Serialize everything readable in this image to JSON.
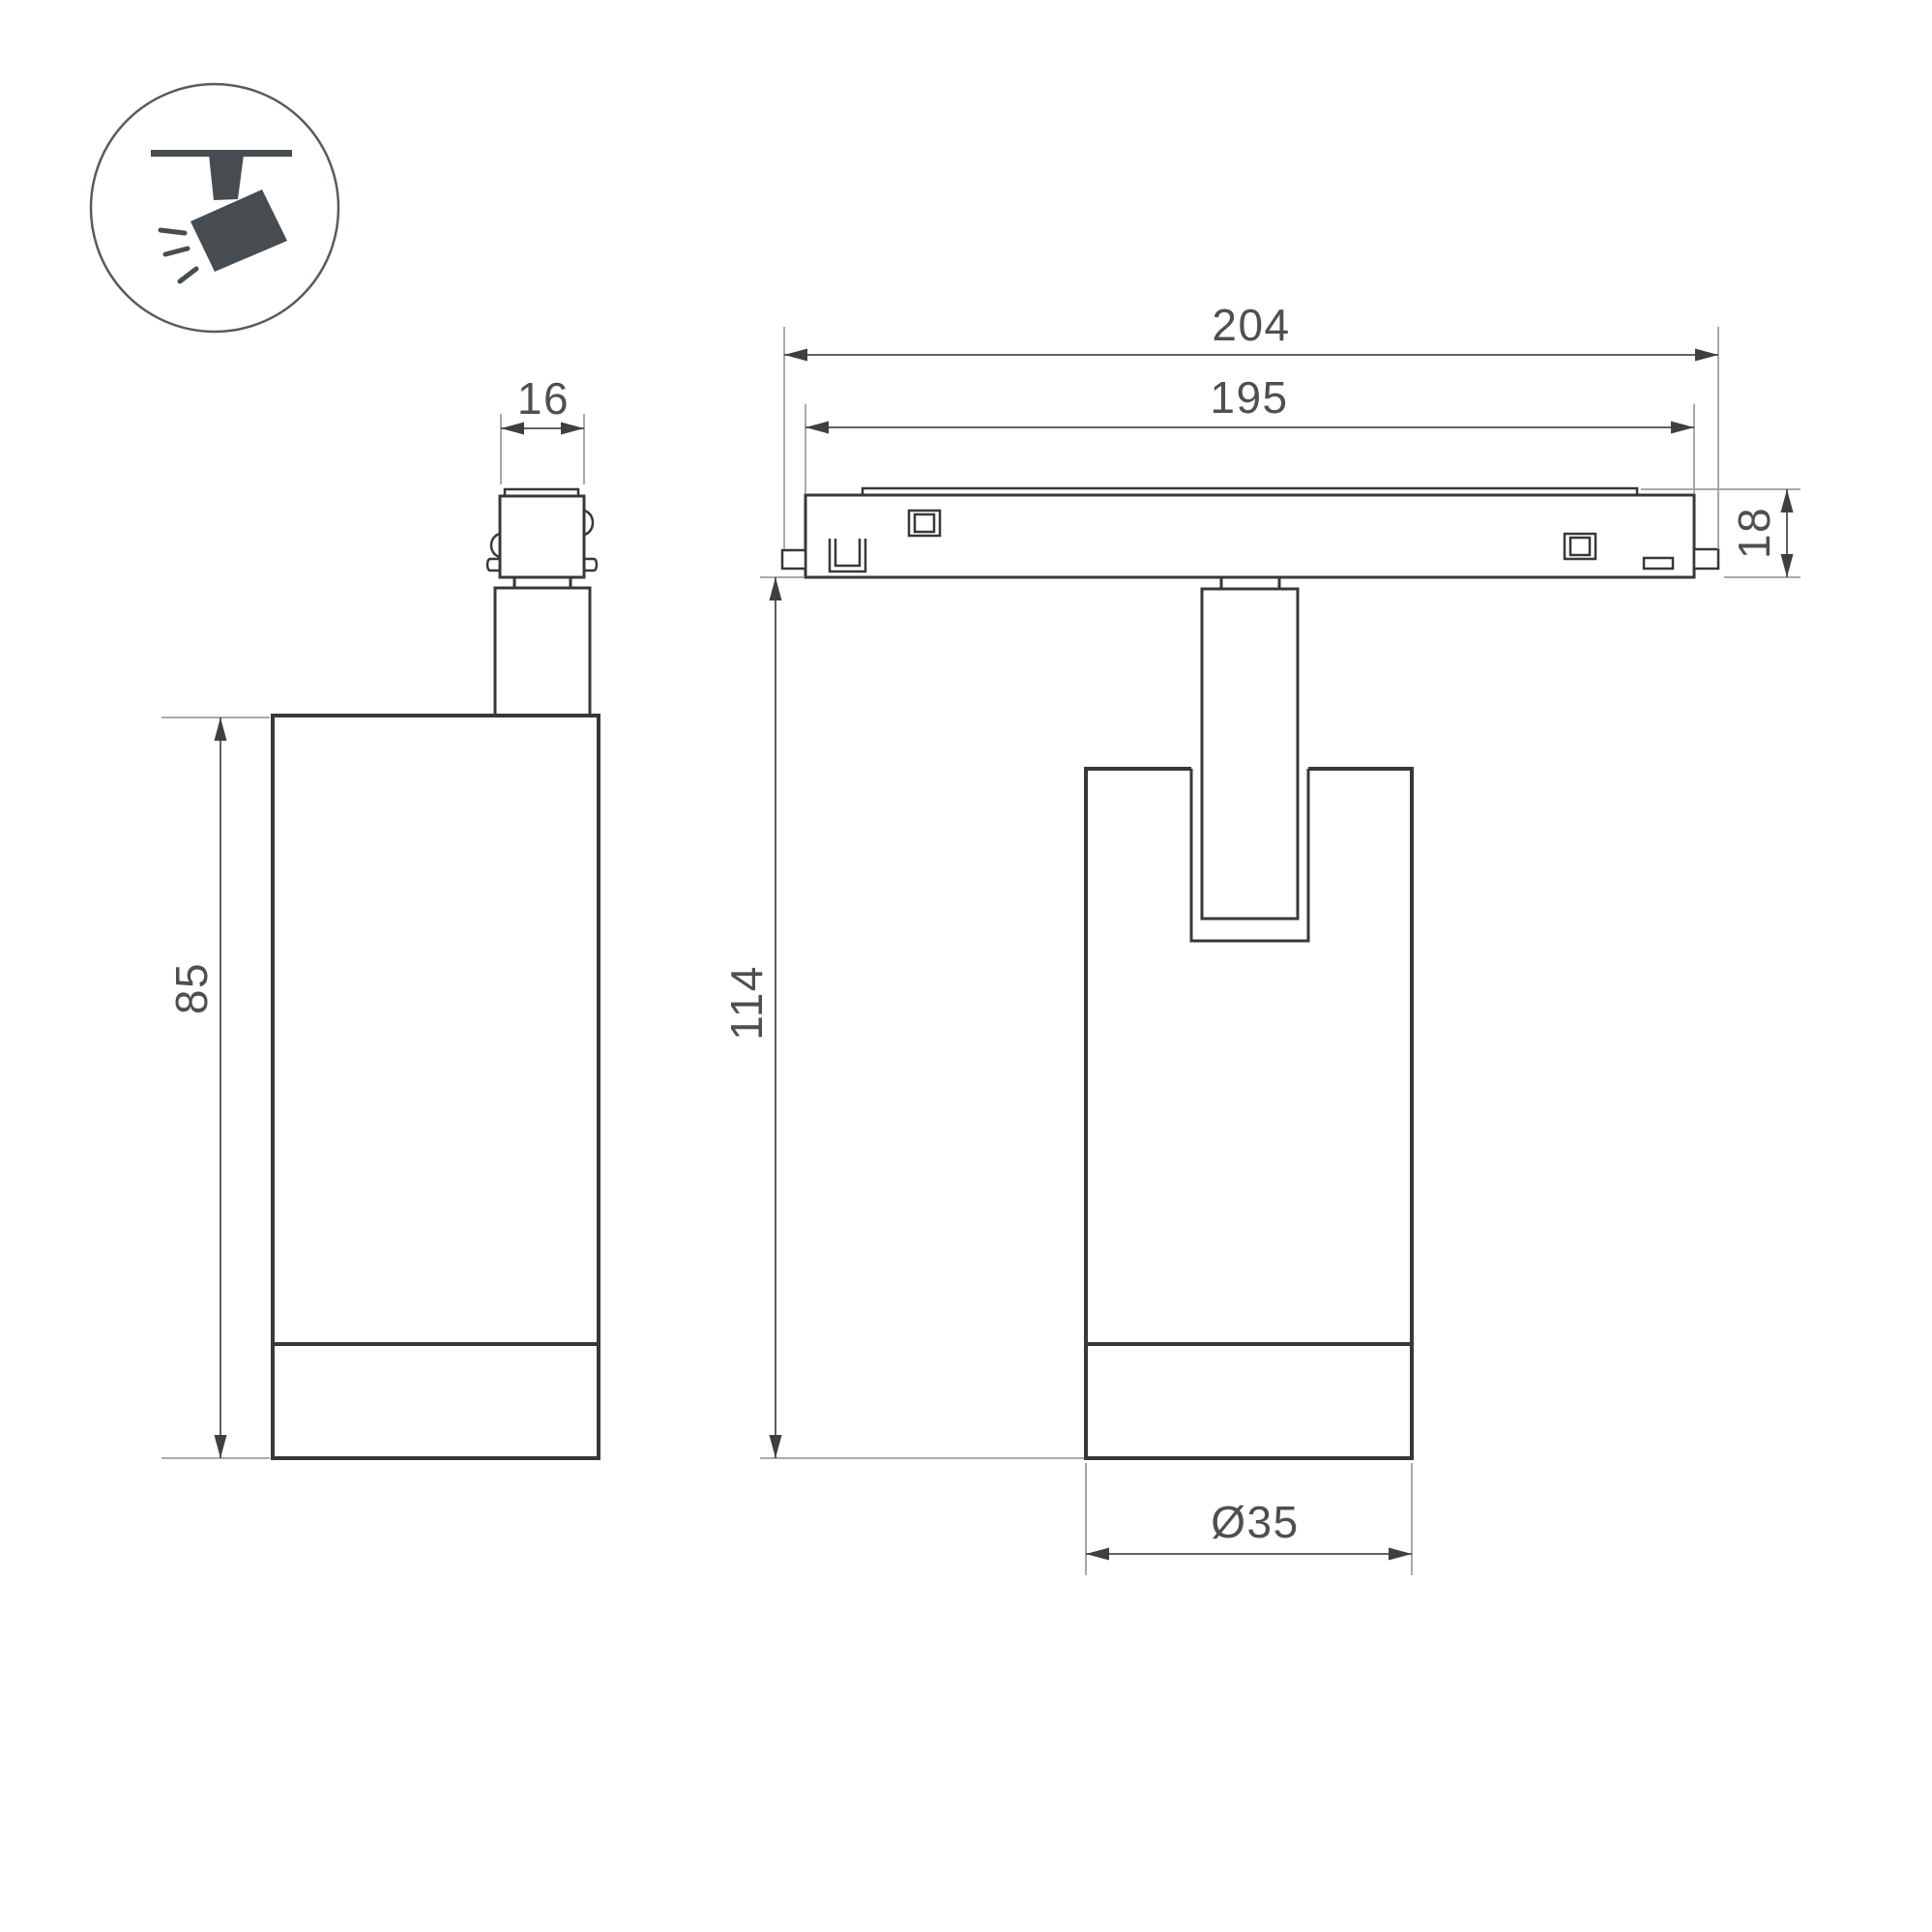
{
  "drawing": {
    "type": "dimensioned technical drawing, ceiling track spotlight",
    "views": {
      "icon_legend": "spotlight-on-track pictogram",
      "left": "side view of luminaire",
      "right": "front view of luminaire on track"
    },
    "colors": {
      "background": "#ffffff",
      "outline": "#383838",
      "dimension_line": "#4d4d4d",
      "extension_line": "#9e9e9e",
      "text": "#4f4f4f",
      "icon": "#474c51"
    }
  },
  "dimensions": {
    "adapter_width": "16",
    "body_height": "85",
    "track_length_outer": "204",
    "track_length_inner": "195",
    "track_height": "18",
    "overall_height": "114",
    "body_diameter": "Ø35"
  }
}
